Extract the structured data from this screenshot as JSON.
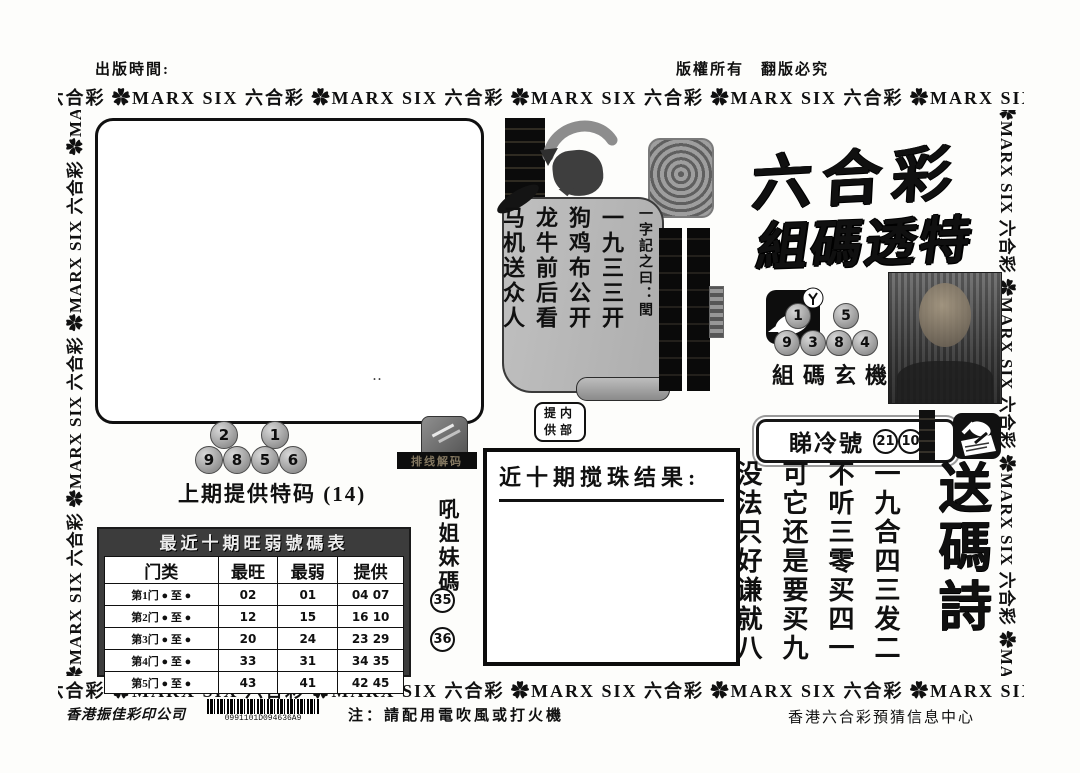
{
  "header": {
    "publish_time": "出版時間:",
    "copyright": "版權所有　翻版必究"
  },
  "border": {
    "cn": "六合彩",
    "flower": "✿",
    "en": "MARX SIX"
  },
  "masthead": {
    "title": "六合彩",
    "subtitle": "組碼透特"
  },
  "scroll": {
    "intro": "一字記之曰：閏",
    "columns": [
      "一九三三开",
      "狗鸡布公开",
      "龙牛前后看",
      "马机送众人"
    ]
  },
  "mystery": {
    "label": "組碼玄機",
    "balls_top": [
      "1",
      "5"
    ],
    "balls_bottom": [
      "9",
      "3",
      "8",
      "4"
    ]
  },
  "cold": {
    "label": "睇冷號",
    "numbers": [
      "21",
      "10"
    ]
  },
  "poem": {
    "title": "送碼詩",
    "columns": [
      "一九合四三发二",
      "不听三零买四一",
      "可它还是要买九",
      "没法只好谦就八",
      "十二生肖排第五"
    ]
  },
  "last_special": {
    "label": "上期提供特码",
    "value": "(14)",
    "balls_top": [
      "2",
      "1"
    ],
    "balls_bottom": [
      "9",
      "8",
      "5",
      "6"
    ]
  },
  "results": {
    "heading": "近十期搅珠结果:"
  },
  "internal": {
    "line1": "提内",
    "line2": "供部"
  },
  "sisters": {
    "label": "吼姐妹碼",
    "numbers": [
      "35",
      "36"
    ]
  },
  "decode_tag": "排线解码",
  "marks": "‥",
  "table": {
    "title": "最近十期旺弱號碼表",
    "headers": [
      "门类",
      "最旺",
      "最弱",
      "提供"
    ],
    "range_suffix": "● 至 ●",
    "rows": [
      [
        "第1门",
        "02",
        "01",
        "04 07"
      ],
      [
        "第2门",
        "12",
        "15",
        "16 10"
      ],
      [
        "第3门",
        "20",
        "24",
        "23 29"
      ],
      [
        "第4门",
        "33",
        "31",
        "34 35"
      ],
      [
        "第5门",
        "43",
        "41",
        "42 45"
      ]
    ]
  },
  "footer": {
    "printer": "香港振佳彩印公司",
    "barcode": "0991101D094636A9",
    "note": "注：請配用電吹風或打火機",
    "center": "香港六合彩預猜信息中心"
  }
}
